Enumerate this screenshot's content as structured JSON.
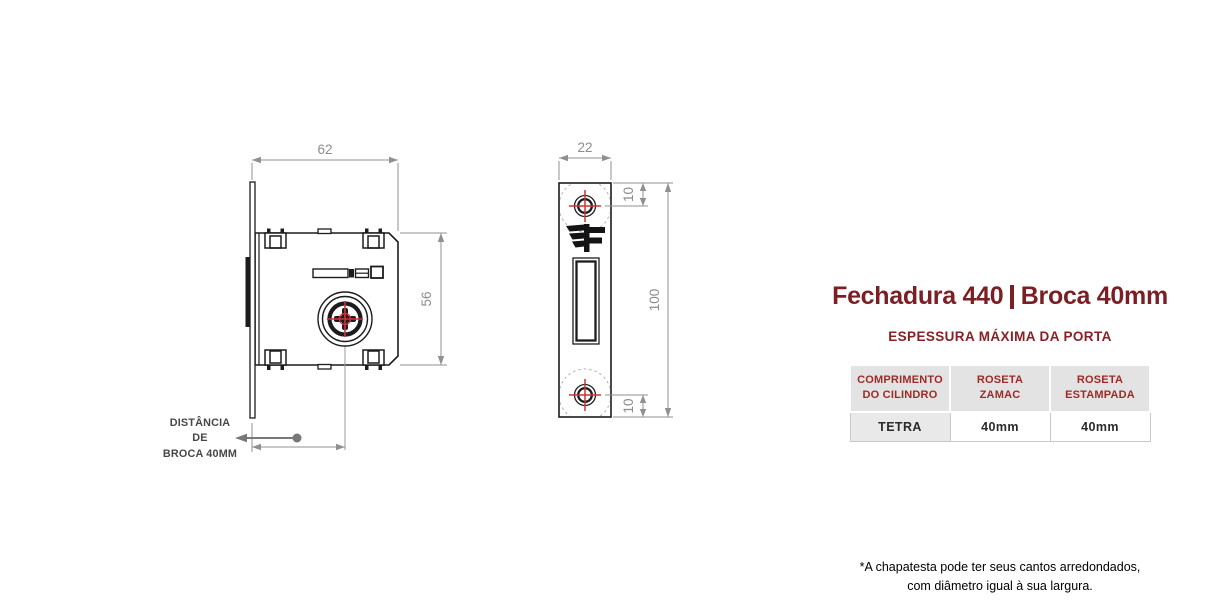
{
  "colors": {
    "accent_maroon": "#7b1f24",
    "table_header_text": "#9e2a28",
    "drawing_red": "#cd3238",
    "dimension_gray": "#8c8c8c",
    "line_black": "#1c1c1c"
  },
  "lock_diagram": {
    "width_dim": "62",
    "height_dim": "56",
    "backset_label": "DISTÂNCIA\nDE\nBROCA 40MM"
  },
  "faceplate_diagram": {
    "width_dim": "22",
    "height_dim": "100",
    "hole_top_dim": "10",
    "hole_bottom_dim": "10"
  },
  "panel": {
    "title_left": "Fechadura 440",
    "title_right": "Broca 40mm",
    "subtitle": "ESPESSURA MÁXIMA DA PORTA",
    "table": {
      "headers": [
        "COMPRIMENTO\nDO CILINDRO",
        "ROSETA\nZAMAC",
        "ROSETA\nESTAMPADA"
      ],
      "rows": [
        [
          "TETRA",
          "40mm",
          "40mm"
        ]
      ]
    },
    "footnote": "*A chapatesta pode ter seus cantos arredondados,\ncom diâmetro igual à sua largura."
  }
}
